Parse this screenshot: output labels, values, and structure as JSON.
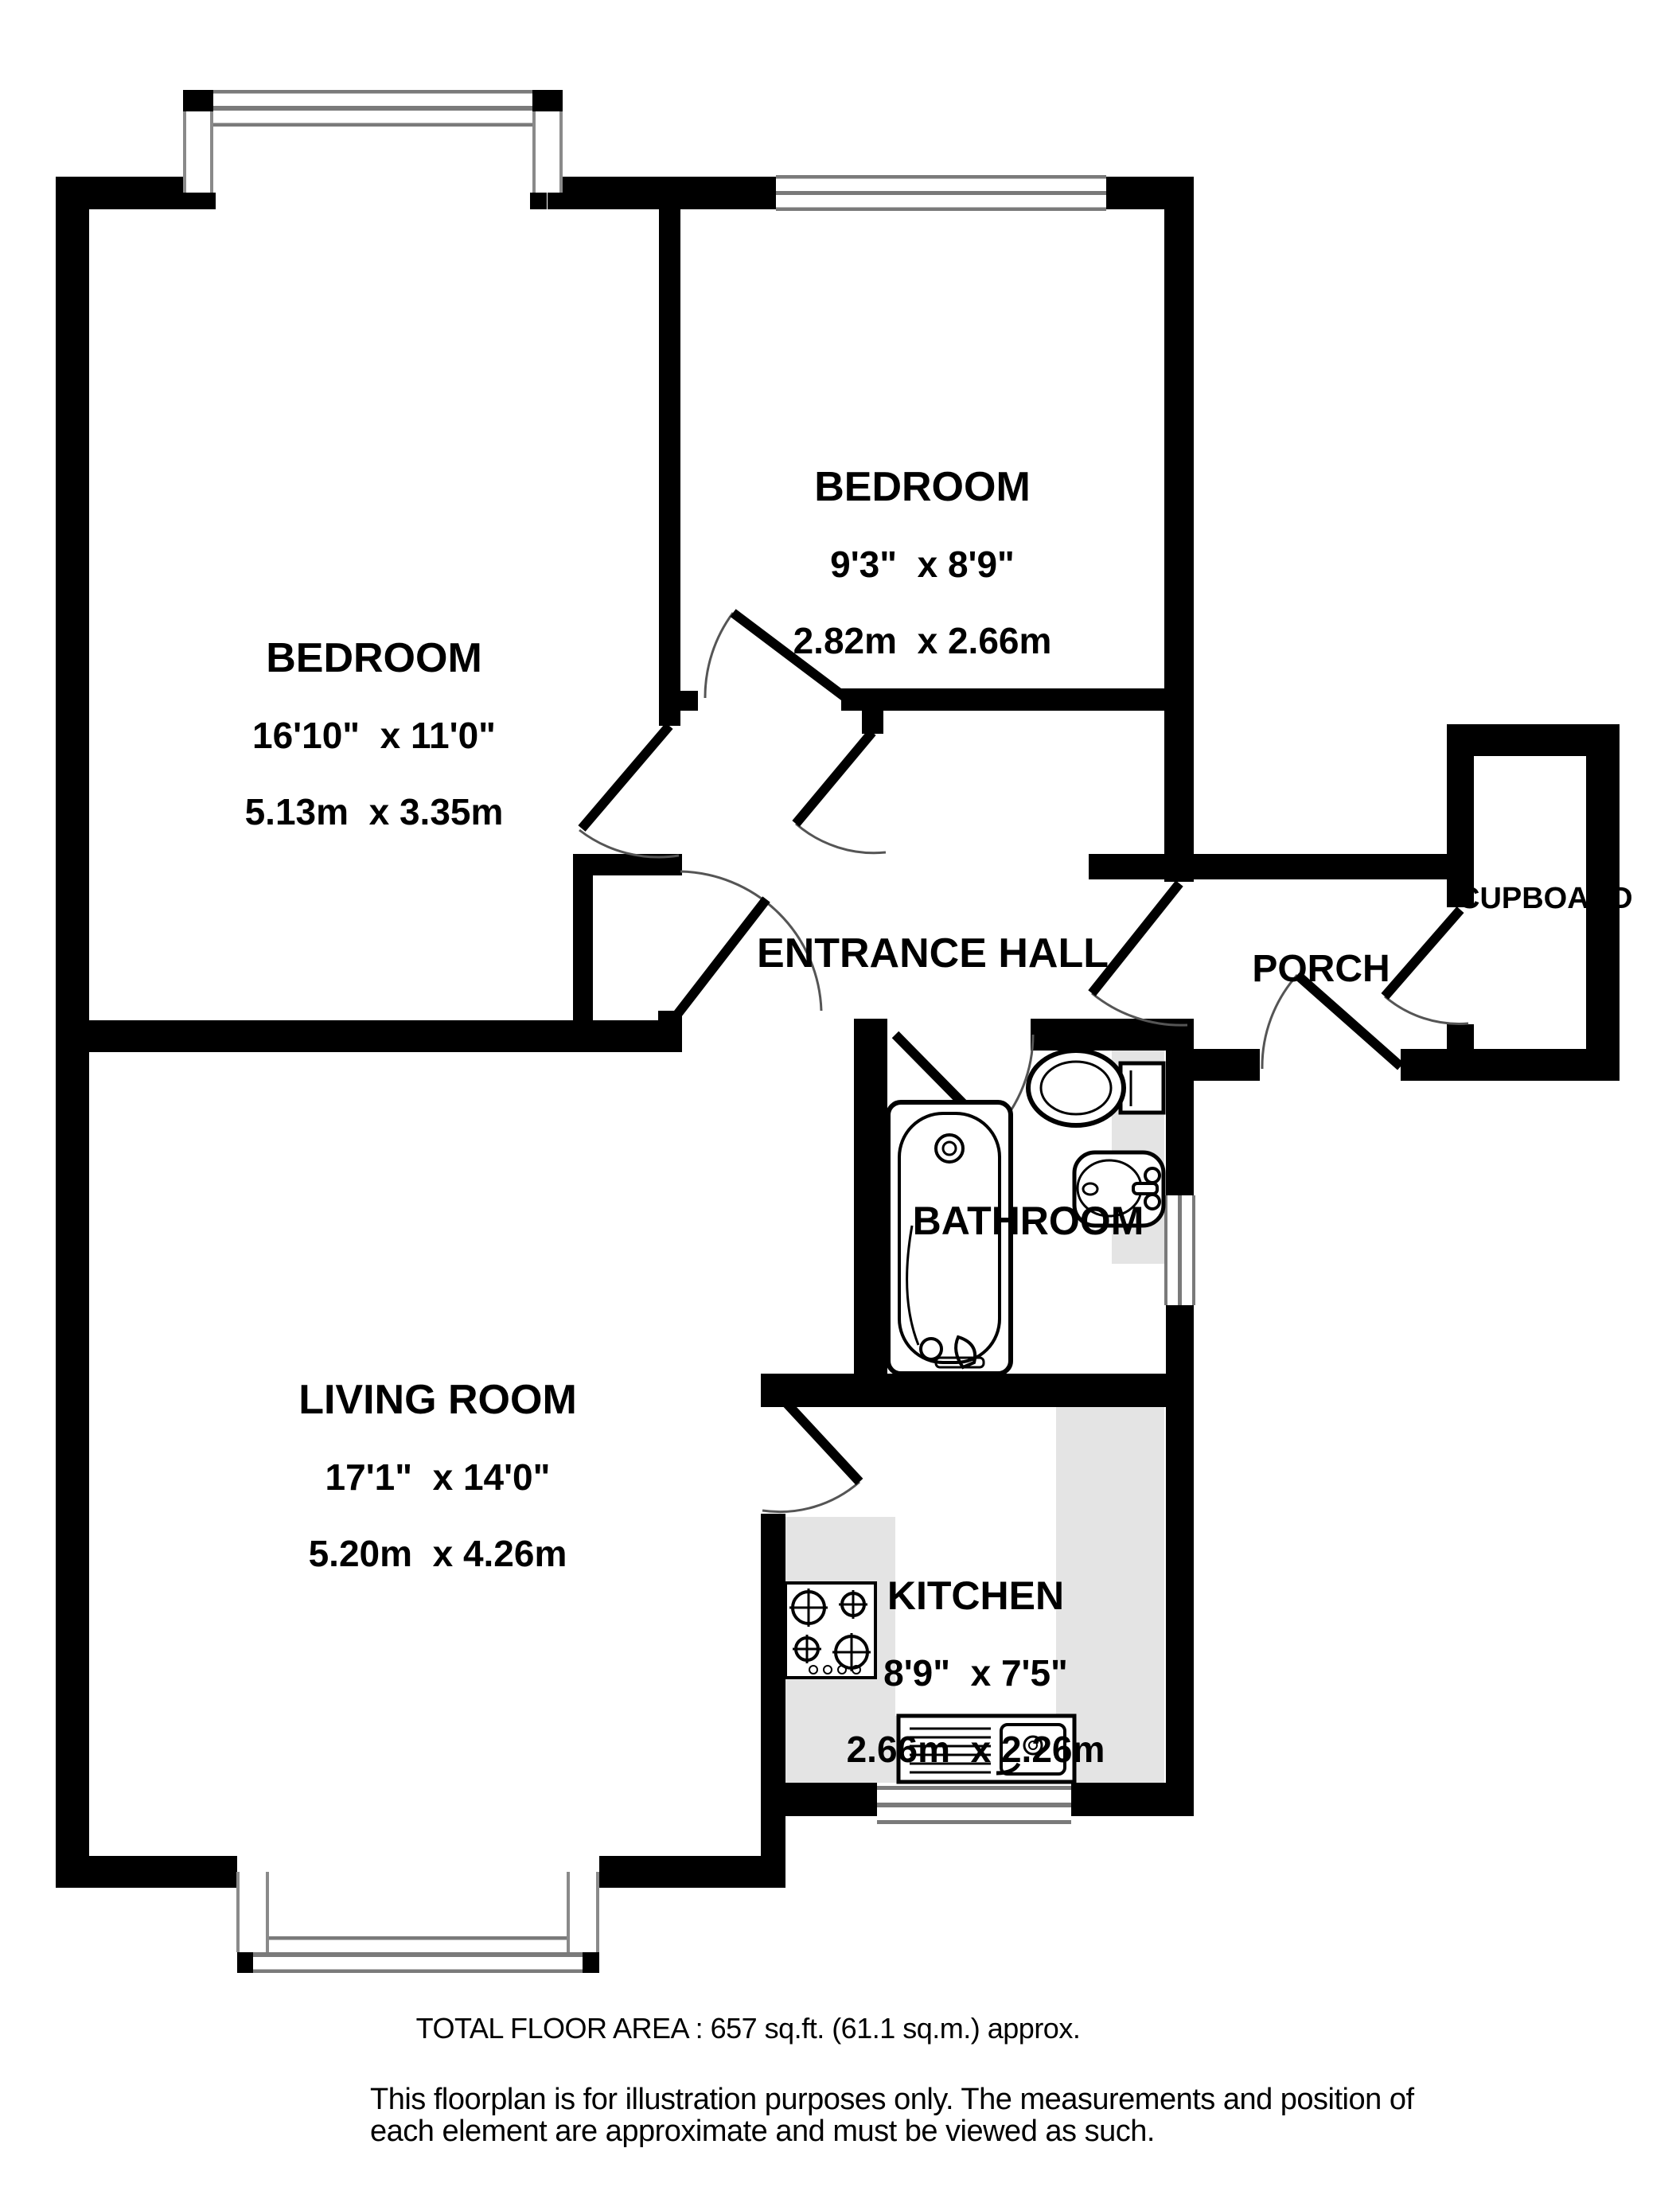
{
  "rooms": {
    "bedroom1": {
      "name": "BEDROOM",
      "imperial": "16'10\"  x 11'0\"",
      "metric": "5.13m  x 3.35m"
    },
    "bedroom2": {
      "name": "BEDROOM",
      "imperial": "9'3\"  x 8'9\"",
      "metric": "2.82m  x 2.66m"
    },
    "living": {
      "name": "LIVING ROOM",
      "imperial": "17'1\"  x 14'0\"",
      "metric": "5.20m  x 4.26m"
    },
    "kitchen": {
      "name": "KITCHEN",
      "imperial": "8'9\"  x 7'5\"",
      "metric": "2.66m  x 2.26m"
    },
    "bathroom": {
      "name": "BATHROOM"
    },
    "hall": {
      "name": "ENTRANCE HALL"
    },
    "porch": {
      "name": "PORCH"
    },
    "cupboard": {
      "name": "CUPBOARD"
    }
  },
  "footer": {
    "total_area": "TOTAL FLOOR AREA : 657 sq.ft. (61.1 sq.m.) approx.",
    "disclaimer_line1": "This floorplan is for illustration purposes only. The measurements and position of",
    "disclaimer_line2": "each element are approximate and must be viewed as such."
  },
  "colors": {
    "wall": "#000000",
    "counter": "#e4e4e4",
    "window_line": "#7a7a7a",
    "door_arc": "#555555"
  },
  "fixtures": [
    "bathtub",
    "toilet",
    "sink-basin",
    "kitchen-sink",
    "hob"
  ]
}
